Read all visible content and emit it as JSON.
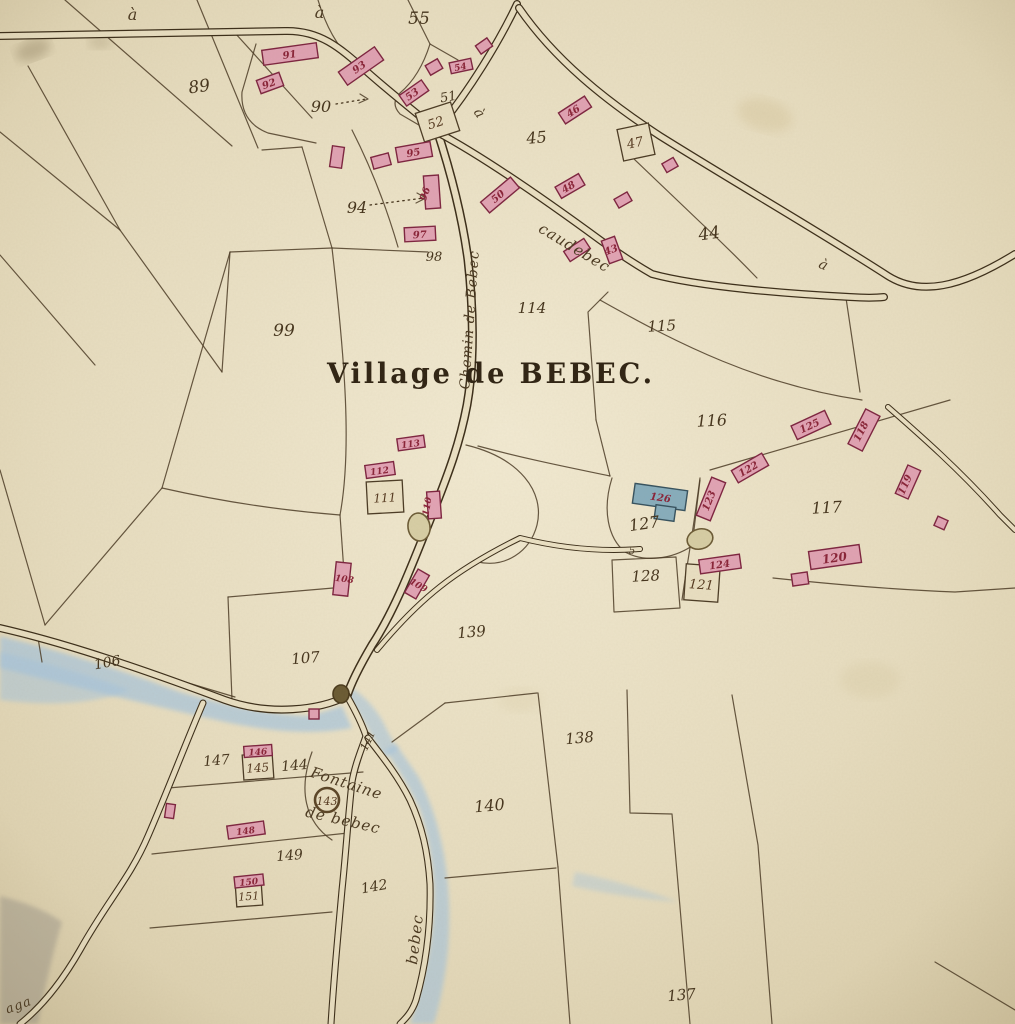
{
  "map": {
    "title": "Village de BEBEC."
  },
  "palette": {
    "paper": "#ebe1c4",
    "paper_hi": "#f2ead2",
    "paper_lo": "#ddd0ac",
    "road_dark": "#3a2c18",
    "road_fill": "#ece2c5",
    "line": "#4a3a24",
    "pink": "#e3a4b6",
    "pink_stroke": "#7e2340",
    "blue": "#87aebe",
    "blue_stroke": "#35515f",
    "water": "#a9c8e2",
    "grey": "#a6a094",
    "beige": "#d8cfa6",
    "beige_stroke": "#6b5a35",
    "ink": "#44331c",
    "crimson": "#8a2238"
  },
  "water": [
    {
      "name": "stream-west",
      "d": "M0 636 Q90 658 180 692 Q255 714 310 716 L342 706 L352 728 Q300 738 225 722 Q110 696 0 668 Z",
      "fill": "#a9c8e2",
      "op": 0.7
    },
    {
      "name": "stream-west-pool",
      "d": "M0 652 Q70 668 130 690 Q80 710 0 700 Z",
      "fill": "#a9c8e2",
      "op": 0.55
    },
    {
      "name": "fork-pool",
      "d": "M352 688 Q370 700 382 720 Q390 736 398 750 L384 758 Q372 736 362 718 Q352 702 344 694 Z",
      "fill": "#a9c8e2",
      "op": 0.6
    },
    {
      "name": "stream-bebec",
      "d": "M385 750 Q405 778 420 810 Q432 846 434 890 Q434 936 424 975 Q418 1000 410 1024 L434 1024 Q444 990 448 950 Q452 900 444 855 Q436 810 418 776 Q404 756 396 744 Z",
      "fill": "#a9c8e2",
      "op": 0.65
    },
    {
      "name": "faint-streak",
      "d": "M575 872 Q625 882 678 902 Q625 898 572 886 Z",
      "fill": "#a9c8e2",
      "op": 0.4
    },
    {
      "name": "grey-corner",
      "d": "M0 896 Q40 906 62 922 Q48 970 38 1024 L0 1024 Z",
      "fill": "#a6a094",
      "op": 0.55
    }
  ],
  "stains": [
    {
      "cx": 33,
      "cy": 50,
      "rx": 18,
      "ry": 10,
      "r": -20,
      "fill": "#6b5a3a",
      "op": 0.28
    },
    {
      "cx": 100,
      "cy": 42,
      "rx": 12,
      "ry": 7,
      "r": 0,
      "fill": "#7a6a46",
      "op": 0.2
    },
    {
      "cx": 765,
      "cy": 115,
      "rx": 28,
      "ry": 16,
      "r": 15,
      "fill": "#d9c9a0",
      "op": 0.45
    },
    {
      "cx": 870,
      "cy": 680,
      "rx": 30,
      "ry": 18,
      "r": 0,
      "fill": "#ddd0ac",
      "op": 0.4
    },
    {
      "cx": 520,
      "cy": 700,
      "rx": 22,
      "ry": 12,
      "r": 0,
      "fill": "#dfd3b0",
      "op": 0.35
    }
  ],
  "parcel_lines": [
    "M65 0 L232 146",
    "M197 0 L258 148",
    "M28 66 L120 230",
    "M0 132 L120 230",
    "M235 33 L312 118",
    "M120 230 L222 372",
    "M0 255 L95 365",
    "M222 372 L230 252",
    "M230 252 L332 248",
    "M230 252 L162 488",
    "M162 488 Q250 508 340 515",
    "M332 248 C345 360 352 450 340 515",
    "M302 147 L332 248",
    "M332 248 L428 252",
    "M352 130 Q380 185 398 247",
    "M262 150 L302 147",
    "M256 44 L242 92 Q240 122 268 133 L316 143",
    "M162 488 L45 625",
    "M0 470 L45 625",
    "M340 515 L345 587",
    "M228 597 L345 587",
    "M228 597 L232 700",
    "M38 638 L235 697",
    "M38 638 L42 662",
    "M408 0 L430 44",
    "M430 44 Q420 76 400 93 Q390 103 400 114 L424 128",
    "M430 44 L458 60",
    "M633 158 L700 222 Q730 250 757 278",
    "M608 292 L588 312 L596 420",
    "M596 420 L610 476",
    "M600 300 C680 345 760 385 862 400",
    "M710 470 L950 400",
    "M478 446 C530 460 572 468 610 476",
    "M612 478 C602 510 608 538 625 552 C645 563 672 559 692 546 L700 480",
    "M700 478 C692 540 686 570 682 600",
    "M612 560 L676 557 L680 608 L614 612 Z",
    "M773 578 C840 585 900 590 955 592 L1015 588",
    "M846 298 L860 392",
    "M445 703 L537 693",
    "M392 742 L445 703",
    "M538 693 L558 867",
    "M558 867 L570 1024",
    "M445 878 L556 868",
    "M627 690 L630 813 L672 814 L690 1024",
    "M732 695 L758 845 L772 1024",
    "M935 962 L1015 1010",
    "M168 788 L363 772",
    "M152 854 L348 833",
    "M150 928 L332 912",
    "M312 752 C298 790 305 822 332 840",
    "M466 445 C520 458 545 492 537 525 C530 552 505 568 478 562",
    "M360 94 L368 99 L359 103",
    "M417 193 L426 198 L416 203",
    "M318 0 Q330 40 352 60"
  ],
  "dotted_arrows": [
    "M336 104 L366 99",
    "M370 205 L424 198"
  ],
  "roads": [
    {
      "name": "road-top-left",
      "d": "M0 36 L285 31 C320 30 340 48 365 70 C385 88 410 108 437 130",
      "o": 8,
      "i": 5.5
    },
    {
      "name": "road-from-north",
      "d": "M517 4 C500 40 470 90 437 130",
      "o": 8,
      "i": 5.5
    },
    {
      "name": "road-chemin-de-bebec",
      "d": "M437 130 C450 170 462 215 468 260 C473 305 475 360 467 405 C460 442 450 470 430 520 C412 565 395 610 372 645 C362 662 352 680 347 696",
      "o": 9,
      "i": 6
    },
    {
      "name": "road-upper-right",
      "d": "M519 8 C555 60 605 100 660 136 C740 186 820 232 888 276 C920 296 960 288 1015 254",
      "o": 8,
      "i": 5.5
    },
    {
      "name": "road-caudebec",
      "d": "M437 132 C480 155 540 196 600 240 C625 258 645 270 652 274 C700 287 790 294 850 297 C865 298 875 298 884 297",
      "o": 8,
      "i": 5.5
    },
    {
      "name": "road-stream-west",
      "d": "M0 628 C70 644 150 672 225 700 C270 716 320 710 347 696",
      "o": 8,
      "i": 5.5
    },
    {
      "name": "road-southwest",
      "d": "M203 703 C185 745 168 790 148 836 C130 878 108 900 80 950 C60 985 40 1008 20 1024",
      "o": 7,
      "i": 4.8
    },
    {
      "name": "road-fountain-west",
      "d": "M347 696 C355 710 362 724 366 736 C362 748 355 764 352 782 C348 818 346 852 342 890 C338 935 334 975 331 1024",
      "o": 7,
      "i": 4.8
    },
    {
      "name": "road-bebec-east",
      "d": "M368 738 C382 756 398 776 410 800 C422 826 428 852 430 884 C431 925 426 965 416 1000 C412 1012 406 1018 400 1024",
      "o": 7,
      "i": 4.8
    },
    {
      "name": "lane-to-church",
      "d": "M377 650 C420 598 455 570 520 538 C560 548 600 552 640 549",
      "o": 6,
      "i": 4
    },
    {
      "name": "lane-southeast",
      "d": "M888 407 C920 435 960 470 1000 515 L1015 530",
      "o": 6,
      "i": 4
    }
  ],
  "ponds": [
    {
      "name": "pond-village",
      "cx": 419,
      "cy": 527,
      "rx": 11,
      "ry": 14,
      "r": -8,
      "kind": "beige"
    },
    {
      "name": "pond-church",
      "cx": 700,
      "cy": 539,
      "rx": 13,
      "ry": 10,
      "r": -15,
      "kind": "beige"
    },
    {
      "name": "pond-junction",
      "cx": 341,
      "cy": 694,
      "rx": 8,
      "ry": 9,
      "r": 0,
      "kind": "dark"
    }
  ],
  "well": {
    "cx": 327,
    "cy": 800,
    "r": 12
  },
  "boxes": [
    {
      "x": 419,
      "y": 107,
      "w": 37,
      "h": 30,
      "r": -18
    },
    {
      "x": 620,
      "y": 126,
      "w": 32,
      "h": 32,
      "r": -12
    },
    {
      "x": 367,
      "y": 481,
      "w": 36,
      "h": 32,
      "r": -3
    },
    {
      "x": 685,
      "y": 565,
      "w": 34,
      "h": 36,
      "r": 4
    },
    {
      "x": 243,
      "y": 754,
      "w": 30,
      "h": 25,
      "r": -4
    },
    {
      "x": 236,
      "y": 884,
      "w": 26,
      "h": 22,
      "r": -4
    }
  ],
  "buildings": [
    {
      "cx": 290,
      "cy": 54,
      "w": 55,
      "h": 15,
      "r": -8,
      "t": "pink"
    },
    {
      "cx": 270,
      "cy": 83,
      "w": 24,
      "h": 14,
      "r": -20,
      "t": "pink"
    },
    {
      "cx": 361,
      "cy": 66,
      "w": 44,
      "h": 16,
      "r": -35,
      "t": "pink"
    },
    {
      "cx": 414,
      "cy": 93,
      "w": 27,
      "h": 13,
      "r": -35,
      "t": "pink"
    },
    {
      "cx": 461,
      "cy": 66,
      "w": 22,
      "h": 11,
      "r": -12,
      "t": "pink"
    },
    {
      "cx": 484,
      "cy": 46,
      "w": 14,
      "h": 10,
      "r": -35,
      "t": "pink"
    },
    {
      "cx": 434,
      "cy": 67,
      "w": 14,
      "h": 11,
      "r": -30,
      "t": "pink"
    },
    {
      "cx": 414,
      "cy": 152,
      "w": 35,
      "h": 15,
      "r": -10,
      "t": "pink"
    },
    {
      "cx": 337,
      "cy": 157,
      "w": 12,
      "h": 21,
      "r": 8,
      "t": "pink"
    },
    {
      "cx": 381,
      "cy": 161,
      "w": 18,
      "h": 12,
      "r": -15,
      "t": "pink"
    },
    {
      "cx": 432,
      "cy": 192,
      "w": 15,
      "h": 33,
      "r": -4,
      "t": "pink"
    },
    {
      "cx": 420,
      "cy": 234,
      "w": 31,
      "h": 14,
      "r": -3,
      "t": "pink"
    },
    {
      "cx": 575,
      "cy": 110,
      "w": 31,
      "h": 13,
      "r": -33,
      "t": "pink"
    },
    {
      "cx": 570,
      "cy": 186,
      "w": 27,
      "h": 13,
      "r": -30,
      "t": "pink"
    },
    {
      "cx": 500,
      "cy": 195,
      "w": 39,
      "h": 14,
      "r": -40,
      "t": "pink"
    },
    {
      "cx": 577,
      "cy": 250,
      "w": 24,
      "h": 12,
      "r": -33,
      "t": "pink"
    },
    {
      "cx": 612,
      "cy": 250,
      "w": 14,
      "h": 24,
      "r": -20,
      "t": "pink"
    },
    {
      "cx": 670,
      "cy": 165,
      "w": 13,
      "h": 10,
      "r": -30,
      "t": "pink"
    },
    {
      "cx": 623,
      "cy": 200,
      "w": 15,
      "h": 10,
      "r": -30,
      "t": "pink"
    },
    {
      "cx": 411,
      "cy": 443,
      "w": 27,
      "h": 12,
      "r": -8,
      "t": "pink"
    },
    {
      "cx": 380,
      "cy": 470,
      "w": 29,
      "h": 13,
      "r": -8,
      "t": "pink"
    },
    {
      "cx": 434,
      "cy": 505,
      "w": 13,
      "h": 27,
      "r": -4,
      "t": "pink"
    },
    {
      "cx": 342,
      "cy": 579,
      "w": 15,
      "h": 33,
      "r": 6,
      "t": "pink"
    },
    {
      "cx": 417,
      "cy": 584,
      "w": 13,
      "h": 27,
      "r": 30,
      "t": "pink"
    },
    {
      "cx": 711,
      "cy": 499,
      "w": 15,
      "h": 41,
      "r": 22,
      "t": "pink"
    },
    {
      "cx": 750,
      "cy": 468,
      "w": 35,
      "h": 14,
      "r": -30,
      "t": "pink"
    },
    {
      "cx": 811,
      "cy": 425,
      "w": 37,
      "h": 15,
      "r": -25,
      "t": "pink"
    },
    {
      "cx": 864,
      "cy": 430,
      "w": 16,
      "h": 39,
      "r": 27,
      "t": "pink"
    },
    {
      "cx": 908,
      "cy": 482,
      "w": 14,
      "h": 31,
      "r": 24,
      "t": "pink"
    },
    {
      "cx": 941,
      "cy": 523,
      "w": 11,
      "h": 10,
      "r": 24,
      "t": "pink"
    },
    {
      "cx": 835,
      "cy": 557,
      "w": 51,
      "h": 18,
      "r": -8,
      "t": "pink"
    },
    {
      "cx": 800,
      "cy": 579,
      "w": 16,
      "h": 12,
      "r": -8,
      "t": "pink"
    },
    {
      "cx": 720,
      "cy": 564,
      "w": 41,
      "h": 14,
      "r": -8,
      "t": "pink"
    },
    {
      "cx": 258,
      "cy": 751,
      "w": 28,
      "h": 11,
      "r": -4,
      "t": "pink"
    },
    {
      "cx": 170,
      "cy": 811,
      "w": 9,
      "h": 14,
      "r": 8,
      "t": "pink"
    },
    {
      "cx": 246,
      "cy": 830,
      "w": 37,
      "h": 13,
      "r": -8,
      "t": "pink"
    },
    {
      "cx": 249,
      "cy": 881,
      "w": 29,
      "h": 11,
      "r": -6,
      "t": "pink"
    },
    {
      "cx": 314,
      "cy": 714,
      "w": 10,
      "h": 10,
      "r": 0,
      "t": "pink"
    },
    {
      "cx": 660,
      "cy": 497,
      "w": 53,
      "h": 20,
      "r": 8,
      "t": "blue"
    },
    {
      "cx": 665,
      "cy": 513,
      "w": 20,
      "h": 14,
      "r": 8,
      "t": "blue"
    }
  ],
  "labels": [
    {
      "t": "89",
      "x": 200,
      "y": 92,
      "r": -8,
      "s": 17,
      "k": "ink"
    },
    {
      "t": "90",
      "x": 321,
      "y": 112,
      "r": 0,
      "s": 16,
      "k": "ink"
    },
    {
      "t": "55",
      "x": 419,
      "y": 24,
      "r": 0,
      "s": 17,
      "k": "ink"
    },
    {
      "t": "51",
      "x": 449,
      "y": 101,
      "r": -10,
      "s": 13,
      "k": "ink"
    },
    {
      "t": "94",
      "x": 357,
      "y": 213,
      "r": 0,
      "s": 16,
      "k": "ink"
    },
    {
      "t": "98",
      "x": 434,
      "y": 261,
      "r": 0,
      "s": 13,
      "k": "ink"
    },
    {
      "t": "99",
      "x": 284,
      "y": 336,
      "r": 0,
      "s": 17,
      "k": "ink"
    },
    {
      "t": "45",
      "x": 537,
      "y": 143,
      "r": -5,
      "s": 16,
      "k": "ink"
    },
    {
      "t": "44",
      "x": 710,
      "y": 239,
      "r": -8,
      "s": 17,
      "k": "ink"
    },
    {
      "t": "114",
      "x": 532,
      "y": 313,
      "r": 0,
      "s": 15,
      "k": "ink"
    },
    {
      "t": "115",
      "x": 662,
      "y": 331,
      "r": -3,
      "s": 15,
      "k": "ink"
    },
    {
      "t": "116",
      "x": 712,
      "y": 426,
      "r": -3,
      "s": 16,
      "k": "ink"
    },
    {
      "t": "117",
      "x": 827,
      "y": 513,
      "r": -3,
      "s": 16,
      "k": "ink"
    },
    {
      "t": "127",
      "x": 645,
      "y": 529,
      "r": -8,
      "s": 16,
      "k": "ink"
    },
    {
      "t": "128",
      "x": 646,
      "y": 581,
      "r": -3,
      "s": 15,
      "k": "ink"
    },
    {
      "t": "106",
      "x": 108,
      "y": 667,
      "r": -10,
      "s": 14,
      "k": "ink"
    },
    {
      "t": "107",
      "x": 306,
      "y": 663,
      "r": -5,
      "s": 15,
      "k": "ink"
    },
    {
      "t": "139",
      "x": 472,
      "y": 637,
      "r": -5,
      "s": 15,
      "k": "ink"
    },
    {
      "t": "138",
      "x": 580,
      "y": 743,
      "r": -5,
      "s": 15,
      "k": "ink"
    },
    {
      "t": "140",
      "x": 490,
      "y": 811,
      "r": -5,
      "s": 16,
      "k": "ink"
    },
    {
      "t": "137",
      "x": 682,
      "y": 1000,
      "r": -5,
      "s": 15,
      "k": "ink"
    },
    {
      "t": "141",
      "x": 371,
      "y": 742,
      "r": -65,
      "s": 11,
      "k": "ink"
    },
    {
      "t": "142",
      "x": 375,
      "y": 891,
      "r": -10,
      "s": 14,
      "k": "ink"
    },
    {
      "t": "144",
      "x": 295,
      "y": 770,
      "r": -5,
      "s": 14,
      "k": "ink"
    },
    {
      "t": "147",
      "x": 217,
      "y": 765,
      "r": -5,
      "s": 14,
      "k": "ink"
    },
    {
      "t": "149",
      "x": 290,
      "y": 860,
      "r": -5,
      "s": 14,
      "k": "ink"
    },
    {
      "t": "5",
      "x": 632,
      "y": 554,
      "r": 0,
      "s": 10,
      "k": "ink"
    },
    {
      "t": "91",
      "x": 290,
      "y": 58,
      "r": -8,
      "s": 10,
      "k": "crimson"
    },
    {
      "t": "92",
      "x": 270,
      "y": 87,
      "r": -20,
      "s": 10,
      "k": "crimson"
    },
    {
      "t": "93",
      "x": 361,
      "y": 70,
      "r": -35,
      "s": 10,
      "k": "crimson"
    },
    {
      "t": "53",
      "x": 414,
      "y": 97,
      "r": -35,
      "s": 10,
      "k": "crimson"
    },
    {
      "t": "54",
      "x": 461,
      "y": 70,
      "r": -12,
      "s": 9,
      "k": "crimson"
    },
    {
      "t": "95",
      "x": 414,
      "y": 156,
      "r": -10,
      "s": 10,
      "k": "crimson"
    },
    {
      "t": "96",
      "x": 428,
      "y": 195,
      "r": -70,
      "s": 10,
      "k": "crimson"
    },
    {
      "t": "97",
      "x": 420,
      "y": 238,
      "r": -3,
      "s": 10,
      "k": "crimson"
    },
    {
      "t": "46",
      "x": 575,
      "y": 114,
      "r": -33,
      "s": 10,
      "k": "crimson"
    },
    {
      "t": "48",
      "x": 570,
      "y": 190,
      "r": -30,
      "s": 10,
      "k": "crimson"
    },
    {
      "t": "50",
      "x": 500,
      "y": 199,
      "r": -40,
      "s": 10,
      "k": "crimson"
    },
    {
      "t": "43",
      "x": 612,
      "y": 253,
      "r": -20,
      "s": 10,
      "k": "crimson"
    },
    {
      "t": "113",
      "x": 411,
      "y": 447,
      "r": -8,
      "s": 9,
      "k": "crimson"
    },
    {
      "t": "112",
      "x": 380,
      "y": 474,
      "r": -8,
      "s": 9,
      "k": "crimson"
    },
    {
      "t": "110",
      "x": 430,
      "y": 507,
      "r": -80,
      "s": 9,
      "k": "crimson"
    },
    {
      "t": "108",
      "x": 344,
      "y": 582,
      "r": 8,
      "s": 9,
      "k": "crimson"
    },
    {
      "t": "109",
      "x": 417,
      "y": 588,
      "r": 30,
      "s": 9,
      "k": "crimson"
    },
    {
      "t": "123",
      "x": 712,
      "y": 502,
      "r": -68,
      "s": 10,
      "k": "crimson"
    },
    {
      "t": "122",
      "x": 750,
      "y": 472,
      "r": -30,
      "s": 10,
      "k": "crimson"
    },
    {
      "t": "125",
      "x": 811,
      "y": 429,
      "r": -25,
      "s": 10,
      "k": "crimson"
    },
    {
      "t": "118",
      "x": 864,
      "y": 433,
      "r": -63,
      "s": 10,
      "k": "crimson"
    },
    {
      "t": "119",
      "x": 908,
      "y": 486,
      "r": -66,
      "s": 10,
      "k": "crimson"
    },
    {
      "t": "120",
      "x": 835,
      "y": 562,
      "r": -8,
      "s": 12,
      "k": "crimson"
    },
    {
      "t": "124",
      "x": 720,
      "y": 568,
      "r": -8,
      "s": 10,
      "k": "crimson"
    },
    {
      "t": "126",
      "x": 660,
      "y": 501,
      "r": 8,
      "s": 10,
      "k": "crimson"
    },
    {
      "t": "146",
      "x": 258,
      "y": 755,
      "r": -4,
      "s": 9,
      "k": "crimson"
    },
    {
      "t": "148",
      "x": 246,
      "y": 834,
      "r": -8,
      "s": 9,
      "k": "crimson"
    },
    {
      "t": "150",
      "x": 249,
      "y": 885,
      "r": -6,
      "s": 9,
      "k": "crimson"
    },
    {
      "t": "52",
      "x": 437,
      "y": 127,
      "r": -18,
      "s": 13,
      "k": "box"
    },
    {
      "t": "47",
      "x": 636,
      "y": 147,
      "r": -12,
      "s": 13,
      "k": "box"
    },
    {
      "t": "111",
      "x": 385,
      "y": 502,
      "r": -3,
      "s": 12,
      "k": "box"
    },
    {
      "t": "121",
      "x": 701,
      "y": 589,
      "r": 4,
      "s": 13,
      "k": "box"
    },
    {
      "t": "145",
      "x": 258,
      "y": 772,
      "r": -4,
      "s": 12,
      "k": "box"
    },
    {
      "t": "151",
      "x": 249,
      "y": 900,
      "r": -4,
      "s": 11,
      "k": "box"
    },
    {
      "t": "143",
      "x": 327,
      "y": 805,
      "r": 0,
      "s": 11,
      "k": "box"
    },
    {
      "t": "à",
      "x": 133,
      "y": 20,
      "r": 0,
      "s": 16,
      "k": "cursive"
    },
    {
      "t": "à",
      "x": 320,
      "y": 18,
      "r": 0,
      "s": 16,
      "k": "cursive"
    },
    {
      "t": "à",
      "x": 476,
      "y": 116,
      "r": 55,
      "s": 14,
      "k": "cursive"
    },
    {
      "t": "à",
      "x": 822,
      "y": 269,
      "r": 25,
      "s": 14,
      "k": "cursive"
    },
    {
      "t": "aga",
      "x": 20,
      "y": 1009,
      "r": -20,
      "s": 13,
      "k": "cursive"
    },
    {
      "t": "caudebec",
      "x": 572,
      "y": 252,
      "r": 31,
      "s": 15,
      "k": "cursive"
    },
    {
      "t": "Chemin de Bebec",
      "x": 474,
      "y": 320,
      "r": -86,
      "s": 14,
      "k": "cursive"
    },
    {
      "t": "bebec",
      "x": 420,
      "y": 940,
      "r": -83,
      "s": 15,
      "k": "cursive"
    },
    {
      "t": "Fontaine",
      "x": 345,
      "y": 788,
      "r": 18,
      "s": 15,
      "k": "cursive"
    },
    {
      "t": "de bebec",
      "x": 342,
      "y": 825,
      "r": 13,
      "s": 15,
      "k": "cursive"
    }
  ]
}
